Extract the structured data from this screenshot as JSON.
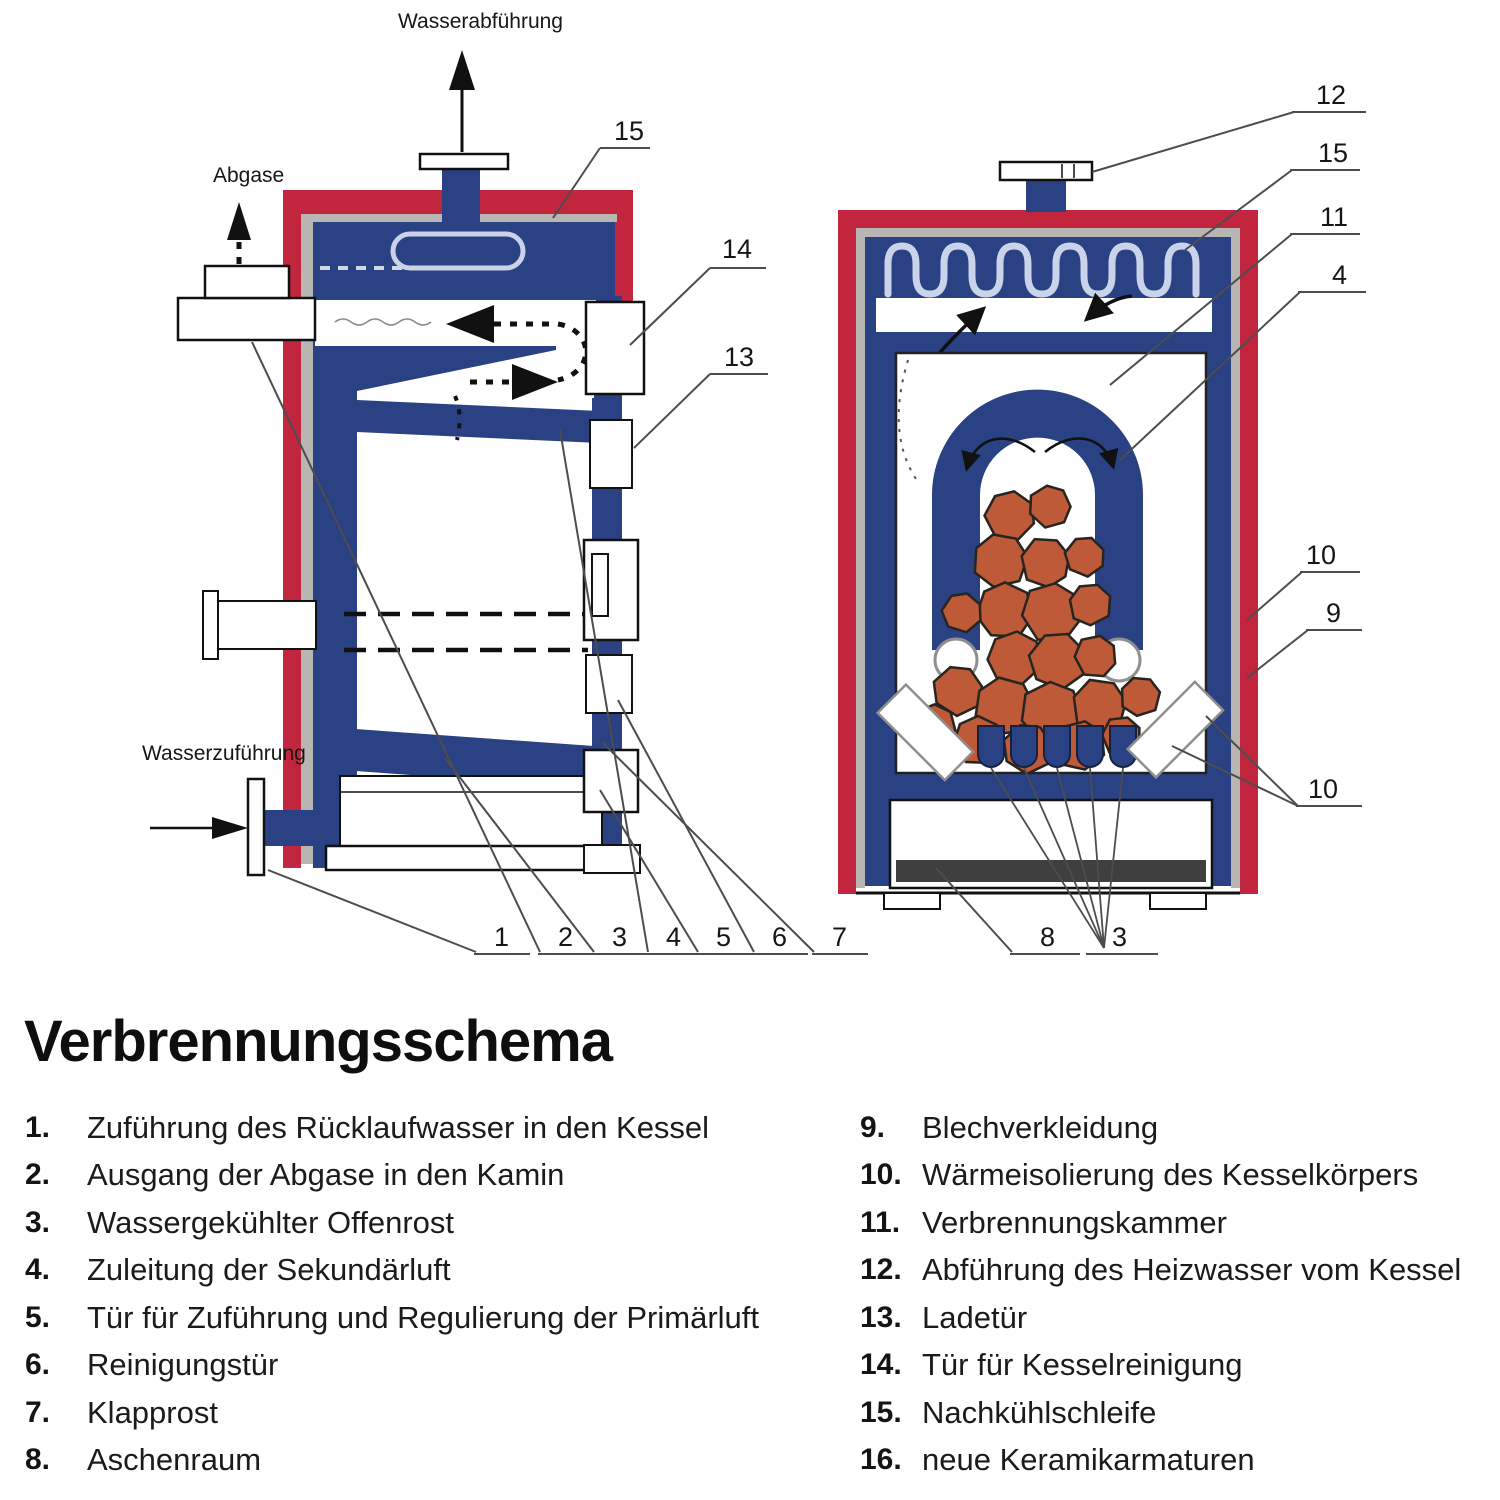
{
  "title": "Verbrennungsschema",
  "diagram": {
    "labels": {
      "water_out": "Wasserabführung",
      "exhaust": "Abgase",
      "water_in": "Wasserzuführung"
    },
    "callouts": {
      "left_side": [
        "15",
        "14",
        "13"
      ],
      "left_bottom": [
        "1",
        "2",
        "3",
        "4",
        "5",
        "6",
        "7"
      ],
      "right_side": [
        "12",
        "15",
        "11",
        "4",
        "10",
        "9",
        "10"
      ],
      "right_bottom": [
        "8",
        "3"
      ]
    }
  },
  "legend": {
    "left": [
      {
        "n": "1.",
        "t": "Zuführung des Rücklaufwasser in den Kessel"
      },
      {
        "n": "2.",
        "t": "Ausgang der Abgase in den Kamin"
      },
      {
        "n": "3.",
        "t": "Wassergekühlter Offenrost"
      },
      {
        "n": "4.",
        "t": "Zuleitung der Sekundärluft"
      },
      {
        "n": "5.",
        "t": "Tür für Zuführung und Regulierung der Primärluft"
      },
      {
        "n": "6.",
        "t": "Reinigungstür"
      },
      {
        "n": "7.",
        "t": "Klapprost"
      },
      {
        "n": "8.",
        "t": "Aschenraum"
      }
    ],
    "right": [
      {
        "n": "9.",
        "t": "Blechverkleidung"
      },
      {
        "n": "10.",
        "t": "Wärmeisolierung des Kesselkörpers"
      },
      {
        "n": "11.",
        "t": "Verbrennungskammer"
      },
      {
        "n": "12.",
        "t": "Abführung des Heizwasser vom Kessel"
      },
      {
        "n": "13.",
        "t": "Ladetür"
      },
      {
        "n": "14.",
        "t": "Tür für Kesselreinigung"
      },
      {
        "n": "15.",
        "t": "Nachkühlschleife"
      },
      {
        "n": "16.",
        "t": "neue Keramikarmaturen"
      }
    ]
  },
  "colors": {
    "shell_red": "#c2263f",
    "water_blue": "#2a4183",
    "insulation_gray": "#b8b6b2",
    "wood_orange": "#bf5a39",
    "ash_dark": "#3f3f3f"
  }
}
